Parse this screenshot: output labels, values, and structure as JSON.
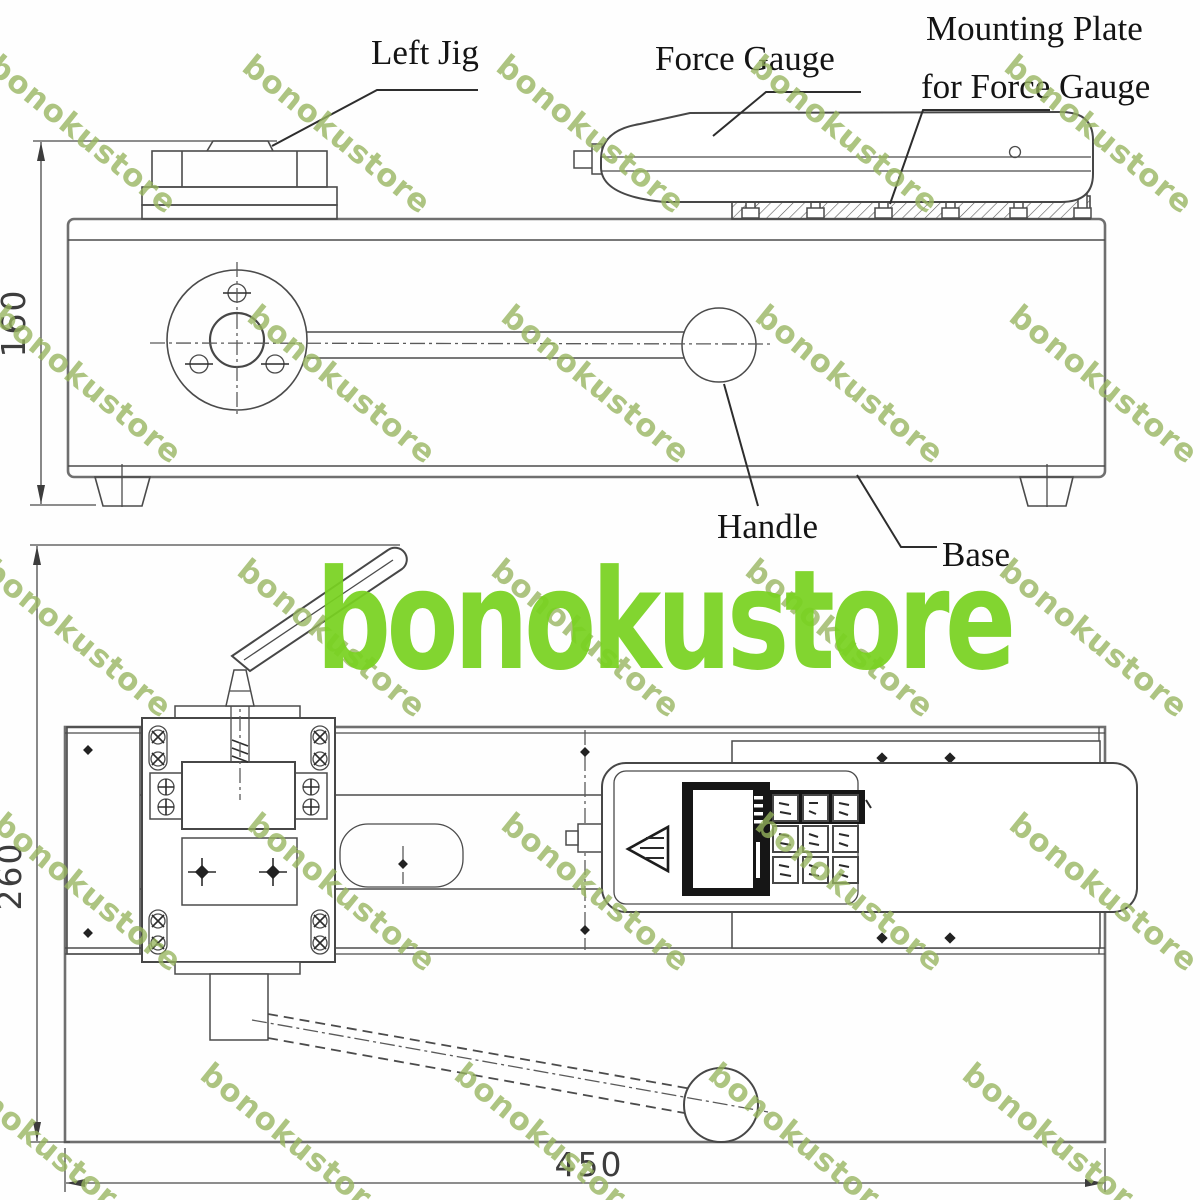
{
  "watermark": {
    "text": "bonokustore",
    "small_color": "#97b55e",
    "big_color": "#79d221"
  },
  "callouts": {
    "left_jig": "Left Jig",
    "force_gauge": "Force Gauge",
    "mounting_plate": [
      "Mounting Plate",
      "for Force Gauge"
    ],
    "handle": "Handle",
    "base": "Base"
  },
  "dimensions": {
    "height": "160",
    "depth": "260",
    "length": "450"
  }
}
